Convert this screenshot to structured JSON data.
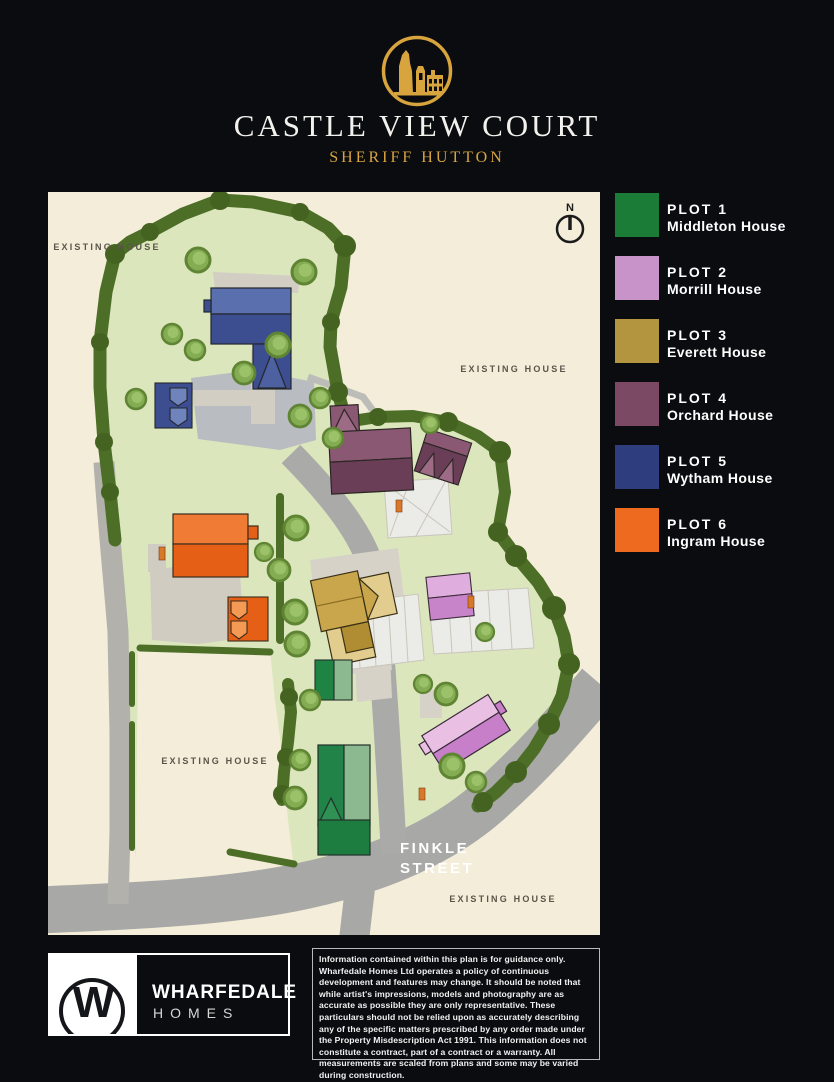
{
  "header": {
    "title": "CASTLE VIEW COURT",
    "subtitle": "SHERIFF HUTTON",
    "logo": "castle-ruins-in-gold-circle"
  },
  "colors": {
    "page_background": "#0b0c10",
    "gold": "#d7a43e",
    "plan_background": "#f3edd9",
    "site_green": "#dbe6bd",
    "tree_dark": "#4c6e27",
    "tree_bright": "#84ac52",
    "road_gray": "#a8a8a6",
    "plot1": "#1b7c38",
    "plot2": "#c893c9",
    "plot3": "#b3953f",
    "plot4": "#7b4963",
    "plot5": "#2e3d7d",
    "plot6": "#ee6a1f"
  },
  "plan": {
    "labels": {
      "existing_house": "EXISTING HOUSE",
      "street_line1": "FINKLE",
      "street_line2": "STREET",
      "north": "N"
    }
  },
  "legend": {
    "items": [
      {
        "plot": "PLOT 1",
        "name": "Middleton House",
        "color": "#1b7c38"
      },
      {
        "plot": "PLOT 2",
        "name": "Morrill House",
        "color": "#c893c9"
      },
      {
        "plot": "PLOT 3",
        "name": "Everett House",
        "color": "#b3953f"
      },
      {
        "plot": "PLOT 4",
        "name": "Orchard House",
        "color": "#7b4963"
      },
      {
        "plot": "PLOT 5",
        "name": "Wytham House",
        "color": "#2e3d7d"
      },
      {
        "plot": "PLOT 6",
        "name": "Ingram House",
        "color": "#ee6a1f"
      }
    ]
  },
  "footer": {
    "logo_letter": "W",
    "brand": "WHARFEDALE",
    "brand_sub": "HOMES",
    "disclaimer": "Information contained within this plan is for guidance only. Wharfedale Homes Ltd operates a policy of continuous development and features may change. It should be noted that while artist's impressions, models and photography are as accurate as possible they are only representative. These particulars should not be relied upon as accurately describing any of the specific matters prescribed by any order made under the Property Misdescription Act 1991. This information does not constitute a contract, part of a contract or a warranty. All measurements are scaled from plans and some may be varied during construction."
  }
}
